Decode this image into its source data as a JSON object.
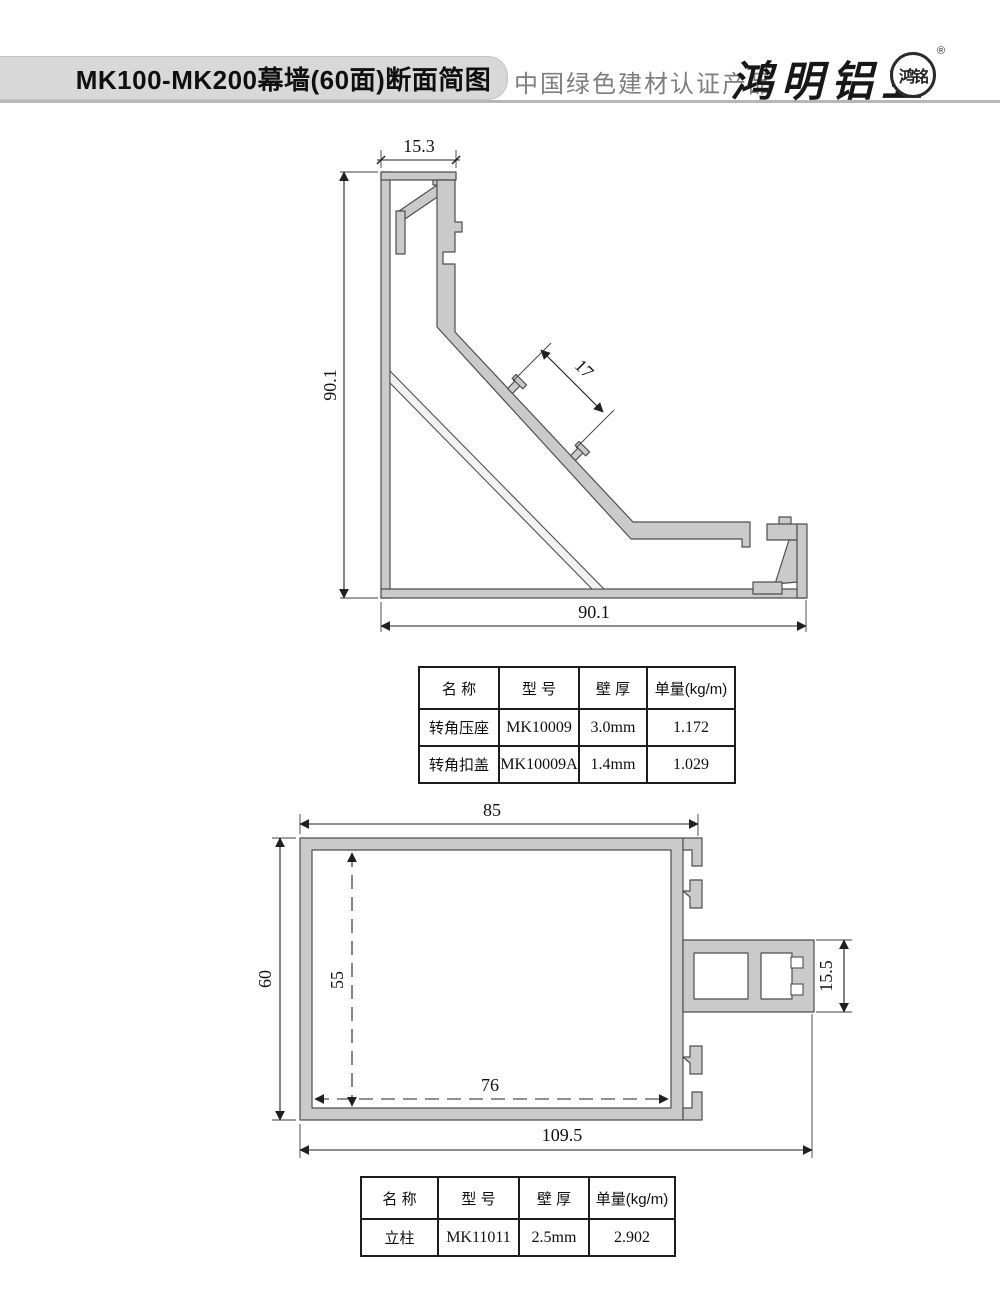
{
  "header": {
    "title": "MK100-MK200幕墙(60面)断面简图",
    "cert_text": "中国绿色建材认证产品",
    "brand_name": "鸿明铝业",
    "seal_text": "鸿铭",
    "registered_mark": "®"
  },
  "drawing1": {
    "name": "corner-profile-cross-section",
    "dims": {
      "top_width": "15.3",
      "left_height": "90.1",
      "bottom_width": "90.1",
      "glass_gap": "17"
    }
  },
  "drawing2": {
    "name": "mullion-cross-section",
    "dims": {
      "top_width": "85",
      "left_height": "60",
      "inner_height": "55",
      "inner_width": "76",
      "overall_width": "109.5",
      "tenon_height": "15.5"
    }
  },
  "tables": [
    {
      "headers": [
        "名  称",
        "型  号",
        "壁  厚",
        "单量(kg/m)"
      ],
      "rows": [
        [
          "转角压座",
          "MK10009",
          "3.0mm",
          "1.172"
        ],
        [
          "转角扣盖",
          "MK10009A",
          "1.4mm",
          "1.029"
        ]
      ]
    },
    {
      "headers": [
        "名  称",
        "型  号",
        "壁  厚",
        "单量(kg/m)"
      ],
      "rows": [
        [
          "立柱",
          "MK11011",
          "2.5mm",
          "2.902"
        ]
      ]
    }
  ],
  "colors": {
    "banner_bg": "#d8d8d8",
    "divider": "#b7b7b7",
    "profile_fill": "#cacaca",
    "profile_stroke": "#4e4e4e",
    "dim_line": "#202020",
    "cert_text": "#7e7e7e"
  }
}
